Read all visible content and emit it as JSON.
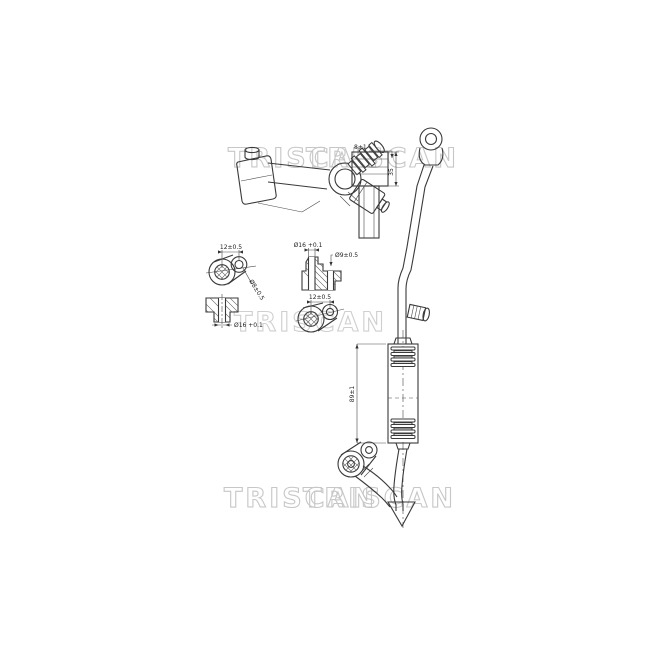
{
  "drawing": {
    "type": "technical-part-drawing",
    "background": "#ffffff",
    "line_color": "#3a3a3a",
    "watermark": {
      "text": "TRISCAN",
      "color": "#c7c7c7"
    },
    "labels": {
      "eyelet_top_hole_spacing": "12±0.5",
      "eyelet_top_hole_dia": "Ø8±0.5",
      "section_top_bore_dia": "Ø16 +0.1",
      "section_top_hole_dia": "Ø9±0.5",
      "section_bottom_bore_dia": "Ø16 +0.1",
      "eyelet_bottom_hole_spacing": "12±0.5",
      "valve_block_height": "8±1",
      "valve_block_length": "35",
      "drier_body_length": "89±1"
    }
  }
}
